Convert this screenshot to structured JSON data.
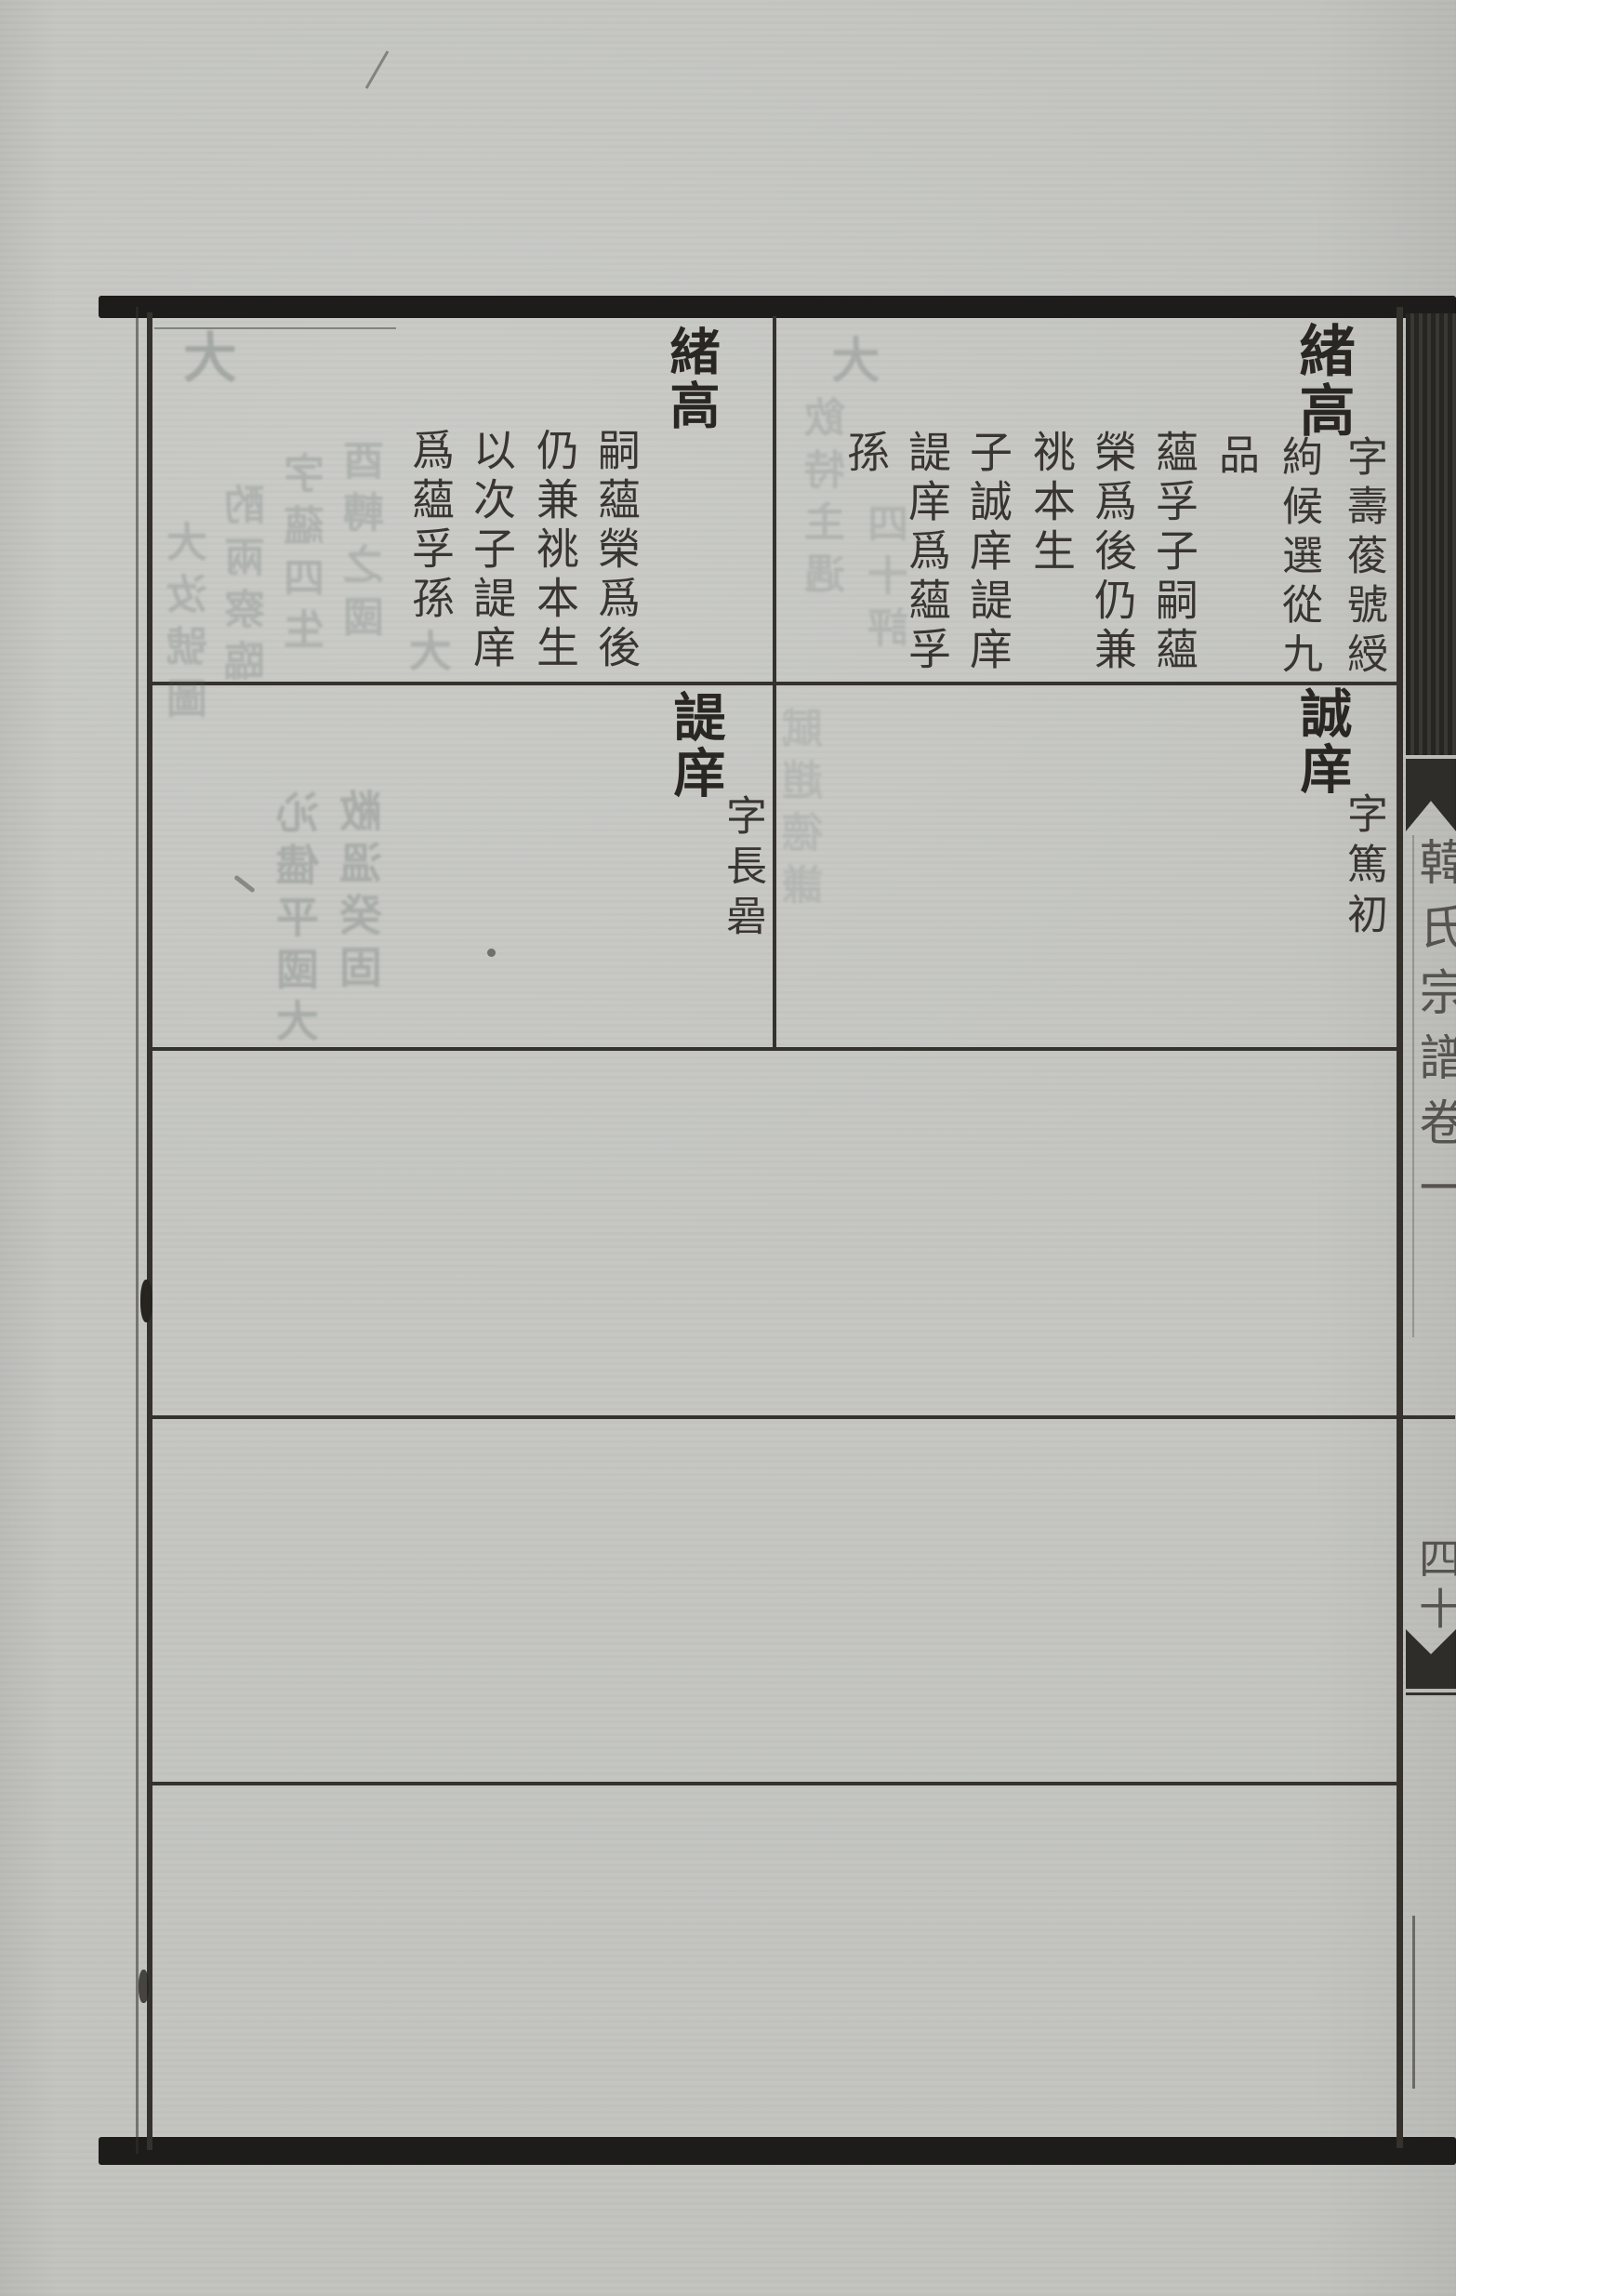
{
  "document": {
    "type": "woodblock-printed genealogy register page (scanned)",
    "script": "traditional Chinese, vertical right-to-left"
  },
  "entries": {
    "xugao_right": {
      "name": "緒高",
      "annotation_col_right": "字壽葰號綬",
      "annotation_col_left": "絇候選從九",
      "annotation_cont": "品",
      "body_columns": [
        "蘊孚子嗣蘊",
        "榮爲後仍兼",
        "祧本生",
        "子誠庠諟庠",
        "諟庠爲蘊孚",
        "孫"
      ]
    },
    "xugao_left": {
      "name": "緒高",
      "body_columns": [
        "嗣蘊榮爲後",
        "仍兼祧本生",
        "以次子諟庠",
        "爲蘊孚孫"
      ]
    },
    "chengxiang": {
      "name": "誠庠",
      "annotation": "字篤初"
    },
    "tixiang": {
      "name": "諟庠",
      "annotation": "字長碞"
    }
  },
  "spine": {
    "title": "韓氏宗譜卷一",
    "page_number": "四十"
  },
  "bleedthrough": {
    "note": "illegible mirrored show-through from reverse side (approximate shapes)",
    "row1_left_corner": "大",
    "row1_left": [
      "酉轉之國",
      "字蘊四生",
      "酌兩察臨",
      "大汝號圖"
    ],
    "row1_left_below": "大",
    "row1_right_corner": "大",
    "row1_right": [
      "四十評",
      "飲特主遇"
    ],
    "row2_left": [
      "敝溫癸固",
      "沁儘平國大"
    ],
    "row2_right": [
      "賦趙德謙"
    ]
  },
  "colors": {
    "paper": "#c7c8c4",
    "ink": "#2a2723",
    "frame": "#35322d",
    "heavy_border": "#1d1c1a",
    "ghost": "#55605e",
    "scan_background": "#ffffff"
  }
}
